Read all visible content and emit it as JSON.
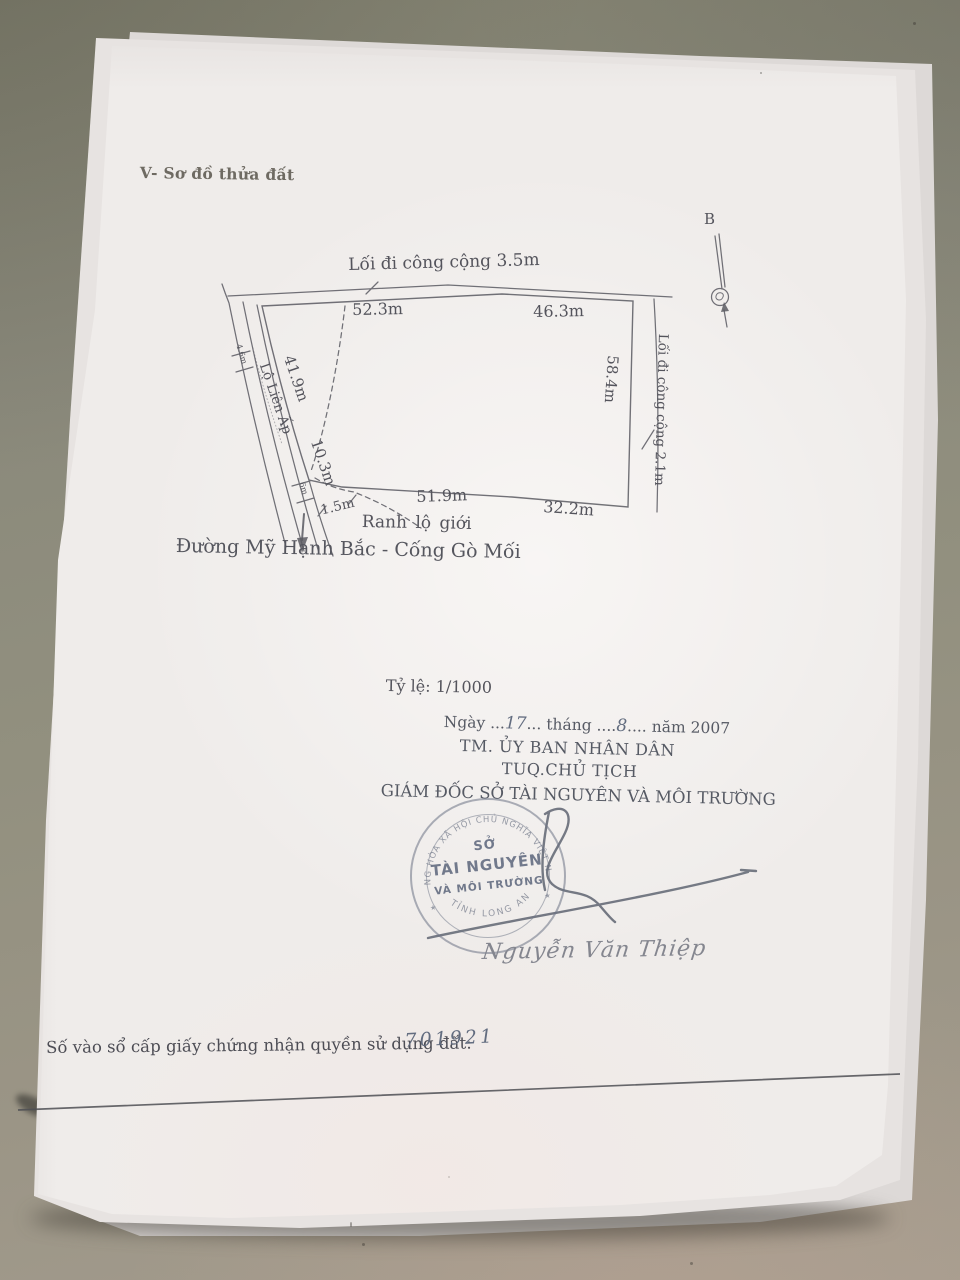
{
  "photo": {
    "table_color": "#8e8c7f",
    "paper_color": "#efecea",
    "ink_color": "#54545c",
    "stamp_ink_color": "#6c7384"
  },
  "document": {
    "section_title": "V- Sơ đồ thửa đất",
    "compass": {
      "north_label": "B"
    },
    "diagram": {
      "top_road_label": "Lối đi công cộng 3.5m",
      "right_road_label": "Lối đi công cộng 2.1m",
      "left_road_label": "Lộ Liên Ấp",
      "boundary_label": "Ranh lộ giới",
      "street_label": "Đường Mỹ Hạnh Bắc - Cống Gò Mối",
      "dimensions": {
        "top_left": "52.3m",
        "top_right": "46.3m",
        "right_side": "58.4m",
        "bottom_inner": "51.9m",
        "bottom_right": "32.2m",
        "left_upper": "41.9m",
        "left_lower": "10.3m",
        "left_tick_upper": "4.6m",
        "left_tick_lower": "6m",
        "setback": "1.5m"
      }
    },
    "scale_label": "Tỷ lệ: 1/1000",
    "date_line": {
      "prefix": "Ngày",
      "dots1": "...",
      "day": "17",
      "dots2": "...",
      "month_word": "tháng",
      "dots3": "....",
      "month": "8",
      "dots4": "....",
      "year_part": "năm 2007"
    },
    "authority": {
      "committee": "TM. ỦY BAN NHÂN DÂN",
      "chairman": "TUQ.CHỦ TỊCH",
      "director": "GIÁM ĐỐC SỞ TÀI NGUYÊN VÀ MÔI TRƯỜNG"
    },
    "stamp": {
      "top_arc": "CỘNG HÒA XÃ HỘI CHỦ NGHĨA VIỆT NAM",
      "center_line1": "SỞ",
      "center_line2": "TÀI NGUYÊN",
      "center_line3": "VÀ MÔI TRƯỜNG",
      "bottom_arc": "TỈNH LONG AN",
      "star": "★"
    },
    "signer_name": "Nguyễn Văn Thiệp",
    "registry": {
      "label": "Số vào sổ cấp giấy chứng nhận quyền sử dụng đất:",
      "number": "701921"
    }
  }
}
